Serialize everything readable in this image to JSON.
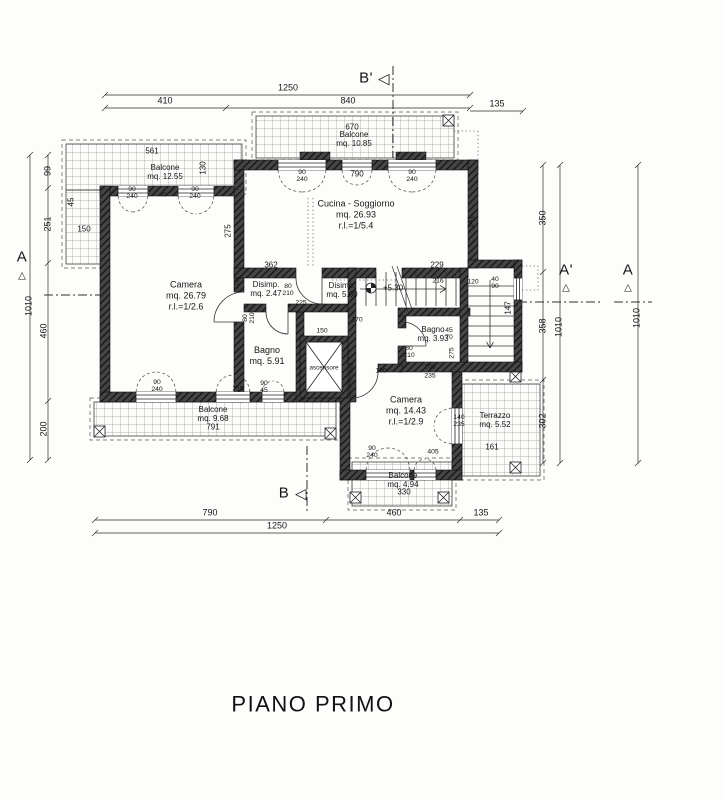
{
  "title": "PIANO PRIMO",
  "markers": {
    "b_prime": "B'",
    "b": "B",
    "tri_left": "◁",
    "a_left": "A",
    "a_right": "A'",
    "a_far": "A",
    "tri_up": "△"
  },
  "rooms": {
    "camera1": "Camera\nmq. 26.79\nr.l.=1/2.6",
    "cucina": "Cucina - Soggiorno\nmq. 26.93\nr.l.=1/5.4",
    "disimp1": "Disimp.\nmq. 2.47",
    "disimp2": "Disimp.\nmq. 5.60",
    "level": "+5.30",
    "bagno1": "Bagno\nmq. 5.91",
    "bagno2": "Bagno\nmq. 3.93",
    "camera2": "Camera\nmq. 14.43\nr.l.=1/2.9",
    "ascensore": "ascensore",
    "balc_tl": "Balcone\nmq. 12.55",
    "balc_top": "Balcone\nmq. 10.85",
    "balc_bl": "Balcone\nmq. 9.68",
    "balc_b": "Balcone\nmq. 4.94",
    "terrazzo": "Terrazzo\nmq. 5.52"
  },
  "dims": {
    "top_total": "1250",
    "top_left": "410",
    "top_right": "840",
    "top_ext": "135",
    "bottom_left": "790",
    "bottom_mid": "460",
    "bottom_ext": "135",
    "bottom_total": "1250",
    "left_1": "99",
    "left_2": "251",
    "left_3": "460",
    "left_4": "200",
    "left_total": "1010",
    "right_1": "350",
    "right_2": "358",
    "right_3": "302",
    "right_total": "1010",
    "far_right_total": "1010"
  },
  "annotations": {
    "balc_tl_width": "561",
    "balc_tl_150": "150",
    "balc_tl_45": "45",
    "balc_tl_130": "130",
    "balc_top_width": "670",
    "cucina_width": "790",
    "cucina_right_h": "341",
    "cucina_362": "362",
    "cucina_229": "229",
    "camera1_275": "275",
    "win_tl_1": "90\n240",
    "win_tl_40": "40",
    "win_tl_2": "90\n240",
    "win_cu_1": "90\n240",
    "win_cu_2": "90\n240",
    "dis1_115": "115",
    "door_80210_a": "80\n210",
    "dis1_225": "225",
    "door_80210_b": "80\n210",
    "elev_150": "150",
    "stair_170": "170",
    "stair_216": "216",
    "stair_120": "120",
    "stair_win": "40\n90",
    "stair_147": "147",
    "bagno2_4570": "45\n70",
    "bagno2_275": "275",
    "door_80210_c": "80\n210",
    "bagno2_100": "100",
    "bagno2_206": "206",
    "bagno2_235": "235",
    "win_bl_1": "90\n240",
    "win_bl_215": "215",
    "win_bl_2": "90\n45",
    "cam2_win": "90\n240",
    "cam2_405": "405",
    "cam2_win2": "140\n235",
    "terr_161": "161",
    "balc_b_330": "330",
    "balc_bl_791": "791"
  }
}
